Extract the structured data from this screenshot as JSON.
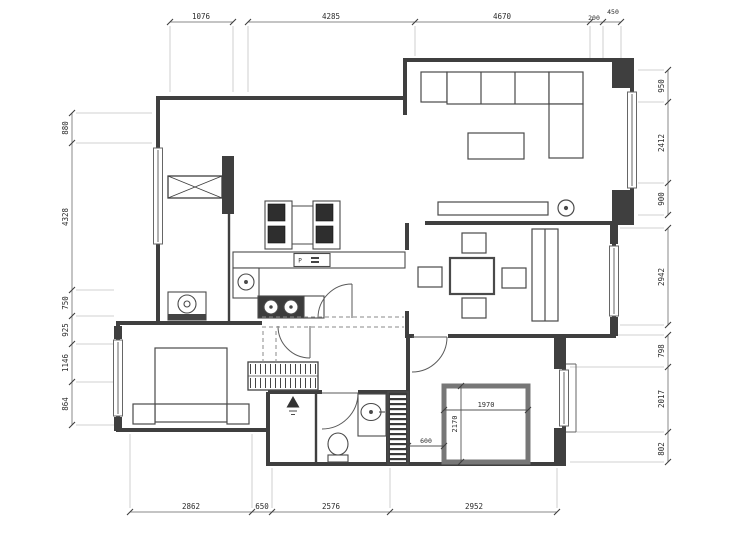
{
  "drawing": {
    "type": "apartment-floor-plan",
    "units": "mm"
  },
  "dimensions": {
    "top": [
      "1076",
      "4285",
      "4670",
      "200",
      "450"
    ],
    "left": [
      "880",
      "4328",
      "750",
      "925",
      "1146",
      "864"
    ],
    "right": [
      "950",
      "2412",
      "900",
      "2942",
      "798",
      "2017",
      "802"
    ],
    "bottom": [
      "2862",
      "650",
      "2576",
      "2952"
    ]
  },
  "interior_dims": {
    "bed_width": "1970",
    "bed_depth": "2170",
    "bed_offset": "600"
  },
  "labels": {
    "kitchen_appliance": "P"
  },
  "colors": {
    "wall": "#3f3f3f",
    "furniture": "#4a4a4a",
    "dark_fill": "#2e2e2e",
    "dimension_line": "#8a8a8a",
    "text": "#2b2b2b",
    "background": "#ffffff"
  }
}
